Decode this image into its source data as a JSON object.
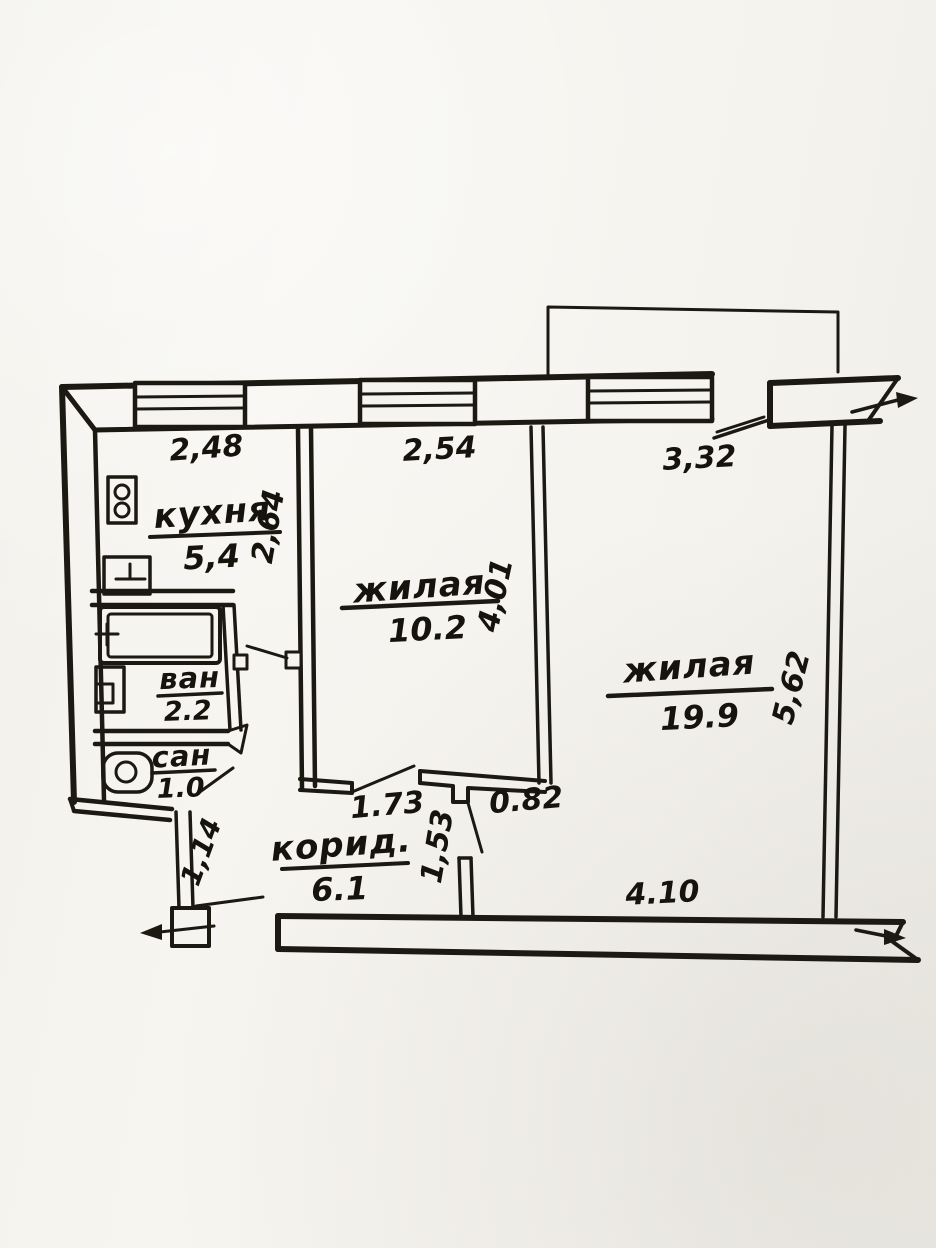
{
  "page": {
    "paper_color": "#f6f4ef",
    "ink_color": "#1c1812"
  },
  "plan": {
    "rooms": {
      "kitchen": {
        "label": "кухня",
        "area": "5,4"
      },
      "living_small": {
        "label": "жилая",
        "area": "10.2"
      },
      "living_large": {
        "label": "жилая",
        "area": "19.9"
      },
      "bath": {
        "label": "ван",
        "area": "2.2"
      },
      "wc": {
        "label": "сан",
        "area": "1.0"
      },
      "corridor": {
        "label": "корид.",
        "area": "6.1"
      }
    },
    "dimensions": {
      "kitchen_width": "2,48",
      "living_small_width": "2,54",
      "living_large_top": "3,32",
      "kitchen_depth": "2,64",
      "living_small_depth": "4,01",
      "living_large_depth": "5,62",
      "corridor_top": "1.73",
      "living_small_door": "0.82",
      "corridor_opening": "1,53",
      "living_large_bottom": "4.10",
      "entry_passage": "1,14"
    }
  }
}
